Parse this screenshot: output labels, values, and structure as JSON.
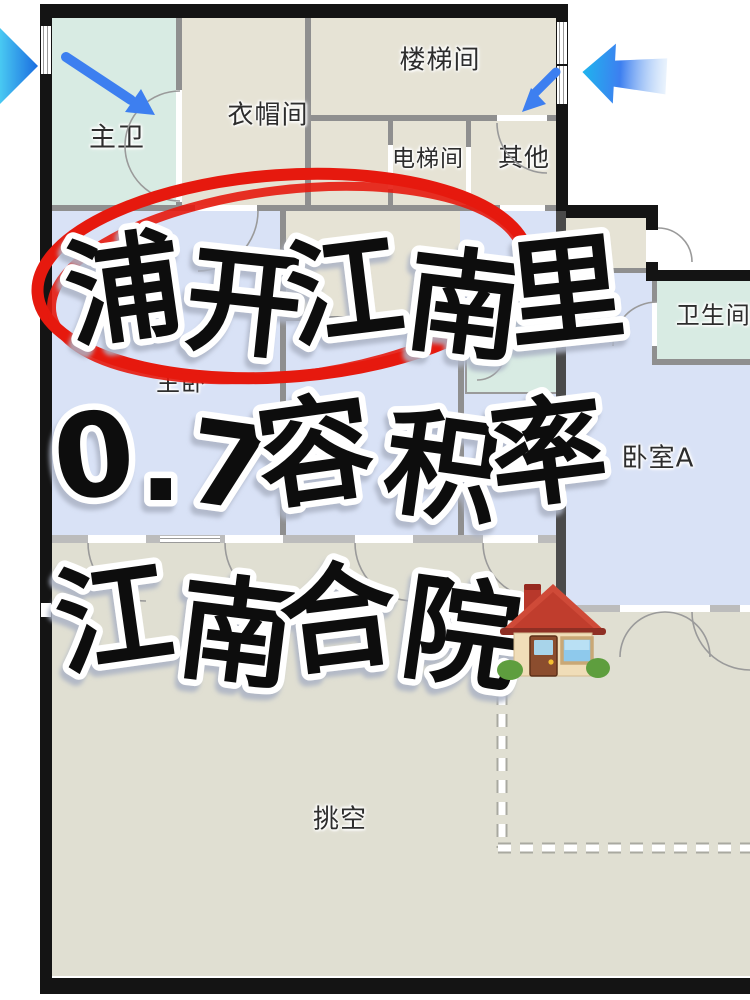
{
  "floorplan": {
    "rooms": {
      "master_bath": {
        "label": "主卫"
      },
      "cloakroom": {
        "label": "衣帽间"
      },
      "stairwell": {
        "label": "楼梯间"
      },
      "elevator": {
        "label": "电梯间"
      },
      "other": {
        "label": "其他"
      },
      "master_bedroom": {
        "label": "主卧"
      },
      "bedroom_partial": {
        "label": "卧"
      },
      "bathroom_a": {
        "label": "卫生间A"
      },
      "bedroom_a": {
        "label": "卧室A"
      },
      "void_space": {
        "label": "挑空"
      }
    },
    "colors": {
      "room_beige": "#e6e3d5",
      "room_teal": "#d8ebe3",
      "room_blue": "#d9e2f6",
      "room_void_gray": "#e0dfd2",
      "wall_black": "#141414",
      "wall_gray": "#8f8f8f"
    }
  },
  "overlay": {
    "line1": "浦开江南里",
    "line2": "0.7容积率",
    "line3": "江南合院",
    "annotation_color": "#e6190e",
    "text_color": "#0a0a0a",
    "outline_color": "#ffffff",
    "arrow_color": "#3b7df0",
    "house_icon": "house-emoji"
  }
}
